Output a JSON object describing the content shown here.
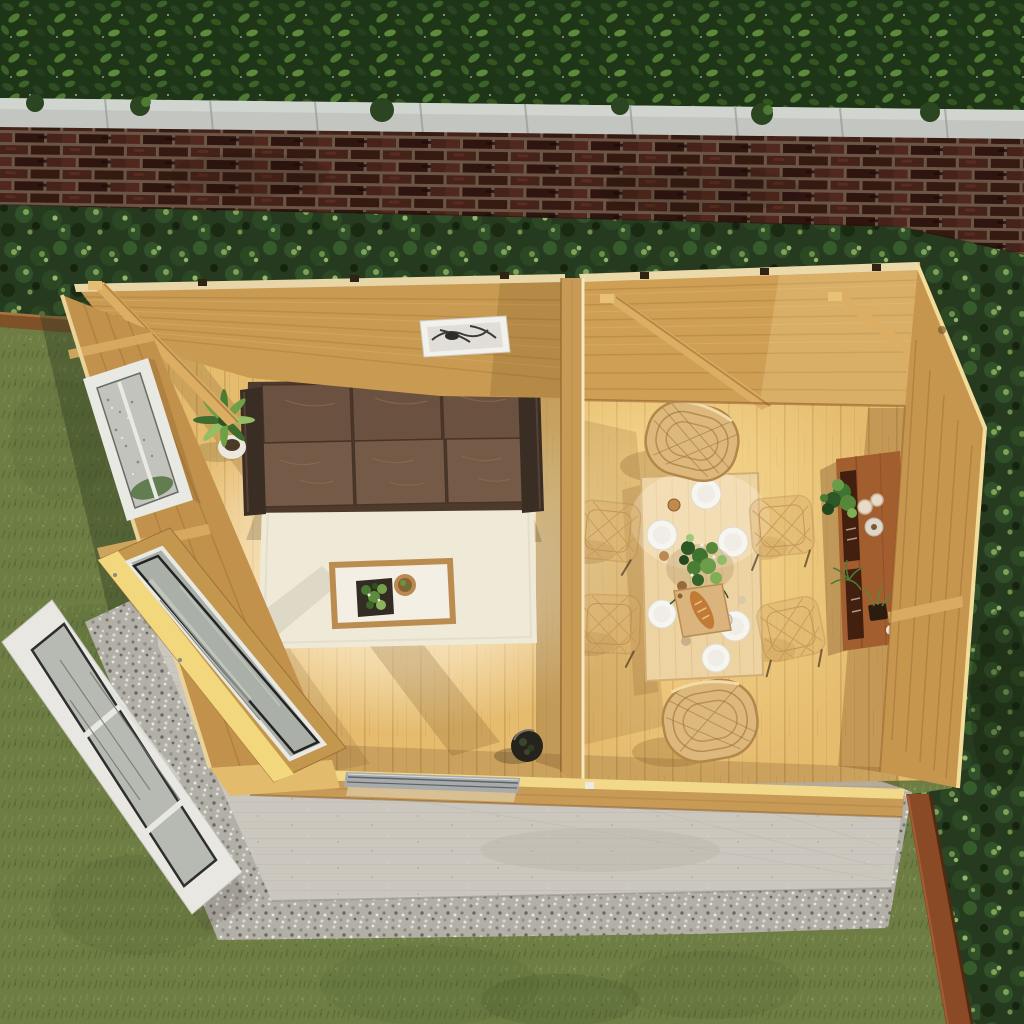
{
  "meta": {
    "type": "3d-product-render",
    "view": "aerial top-down",
    "subject": "Wooden garden room with open bifold doors, lounge and dining areas, seen from above in a walled garden"
  },
  "palette": {
    "hedge": "#223a19",
    "coping_stone": "#c3c6c0",
    "brick_wall": "#42231a",
    "shrub_border": "#2c4423",
    "grass": "#6d7d43",
    "gravel": "#b2afa7",
    "concrete_patio": "#cbc7be",
    "corten_edging": "#8a4a26",
    "cabin_wall_wood": "#c99a52",
    "floor_wood": "#e5bb6e",
    "sunlit_wood": "#f2d989",
    "sofa_leather": "#6b5140",
    "rug": "#efe9d8",
    "rattan_chair": "#dcb87c",
    "dining_table": "#edd3a2",
    "sideboard": "#a35e2f",
    "door_glass": "#aab0a8",
    "white_door_frame": "#e8e7e2",
    "window_frame": "#e9e9e4"
  },
  "scene": {
    "labels": {
      "root": "Aerial render of garden log cabin interior and garden",
      "hedge": "evergreen hedge",
      "coping": "stone wall coping",
      "brick_wall": "brick boundary wall",
      "shrubs": "planted shrub border",
      "lawn": "lawn",
      "wood_border": "timber bed edging",
      "gravel": "gravel border",
      "concrete": "concrete patio slab",
      "corten": "steel garden edging",
      "cabin": "garden room",
      "floor": "timber floor",
      "lounge": "lounge area",
      "dining": "dining area",
      "sofa": "brown leather three-seat sofa",
      "rug": "cream rug",
      "coffee_table": "coffee table with plant and bowl",
      "corner_plant": "potted plant",
      "floor_pot": "dark plant pot",
      "picture": "framed wall print",
      "window": "side window",
      "partition": "partition wall",
      "dining_table": "dining table set for six",
      "rattan_chair_top": "rattan chair",
      "rattan_chair_bottom": "rattan chair",
      "wire_chair": "wire mesh dining chair",
      "sideboard": "sideboard with plants and glasses",
      "bifold_doors": "open bifold glass doors",
      "beam": "roof beam"
    }
  }
}
